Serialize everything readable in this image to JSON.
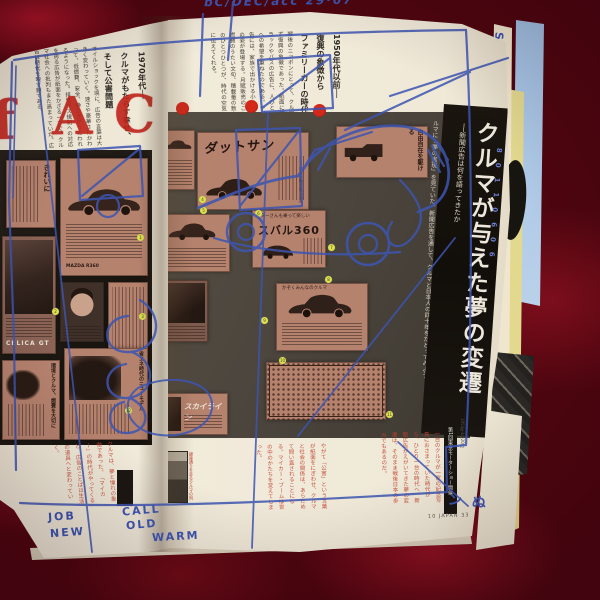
{
  "scene": {
    "description": "open magazine spread on red velvet",
    "colors": {
      "velvet": "#4e050f",
      "velvet_highlight": "#8f1120",
      "page": "#f0e9d8",
      "panel_black": "#211b15",
      "panel_gray": "#4d463d",
      "ad_pink": "#b5826e",
      "ink_blue": "#3d55b2",
      "stamp_red": "#c0231a",
      "body_red_text": "#c0402e",
      "dot_yellow": "#dde04a",
      "band_black": "#16110c",
      "sky_edge": "#a9c3e2",
      "yellow_edge": "#e2d88e"
    }
  },
  "handwriting": {
    "top_note": "bC/DEC/acc  29·07",
    "bottom_words": [
      "JOB",
      "NEW",
      "CALL",
      "OLD",
      "WARM"
    ],
    "corner_chars": [
      "ン",
      "ぬ"
    ],
    "edge_letters": [
      "S",
      "E",
      "M",
      "A"
    ],
    "edge_code": "80110606"
  },
  "left_page": {
    "section_headline": [
      "1970年代──",
      "クルマがもたらす幸せ、",
      "そして公害問題"
    ],
    "body_text": "オイルショックを境に、広告の言葉は大きく変わっていく。速さや豪華さにかわって、低燃費、安全、静かさがうたわれるようになった。排気ガス規制への対応を誇る広告が紙面をかざる一方で、クルマ社会への批判もまた高まっていた。広告は時代を映す鏡である。",
    "stencil_letters": [
      "f",
      "A",
      "C"
    ],
    "ads": {
      "kirei_title": "きれいに",
      "mazda_label": "MAZDA R360",
      "celica_label": "CELICA GT",
      "headline_a": "環境とクルマ、燃費を大切に",
      "headline_b": "省エネ時代のニューモデル"
    }
  },
  "right_page": {
    "section_headline": [
      "1950年代以前──",
      "復興の象徴から",
      "ファミリーカーの時代へ"
    ],
    "body_text": "戦後のニッポンにとって、クルマはまず復興の象徴であった。紙面に並ぶトラックやバスの広告に、人びとは明日への希望を重ねたのである。やがて広告には、家族で出かける小さな乗用車の姿が登場する。月賦販売のことば、燃費のうたい文句、積載量の数字。そのひとつひとつが、時代の空気をいまに伝えてくれる。",
    "main_headline": "クルマが与えた夢の変遷",
    "main_subtitle": "──新聞広告は何を語ってきたか",
    "intro_text": "「マイカー」という言葉が、限りない憧れをあつめていた時代があった。高度成長のただなかで、日本人はクルマに「夢の実現」を見ていた。新聞広告を通して、クルマと日本人の四十年をたどってみよう。",
    "ads": {
      "datsun_title": "ダットサン",
      "datsun_maker": "日産自動車株式会社",
      "jiyu_title": "自由自在を駆ける",
      "subaru_lead": "スターさんも乗って楽しい",
      "subaru_name": "スバル360",
      "sedan_lead": "かぞくみんなのクルマ",
      "skyline_title": "スカイライン"
    }
  },
  "bottom": {
    "red_text_left": "クルマは、夢と憧れの象徴であった。「マイカー」の時代がやってくると、広告のことばは生活の道具へと変わっていく。",
    "red_text_mid": "やがて「公害」という言葉が紙面をにぎわせ、クルマと社会の関係は、あらためて問い直されることになる。マイカー・ブームは世の中のかたちを変えてしまった。",
    "red_text_right": "一台のクルマが一家の記念写真におさまっていた時代から、ひとり一台の時代へ。新聞広告がえがいてきた夢の変遷は、そのまま戦後日本の歩みでもあるのだ。",
    "caption_bar": "第1回東京モーターショー開催",
    "date_note": "1954年4月20日",
    "photo_caption": "銀座通りを走るクルマの列",
    "footer": "10 JAPAN 33"
  },
  "annotations": {
    "dot_numbers": [
      "1",
      "2",
      "3",
      "4",
      "5",
      "6",
      "7",
      "8",
      "9",
      "10",
      "11",
      "12"
    ]
  }
}
